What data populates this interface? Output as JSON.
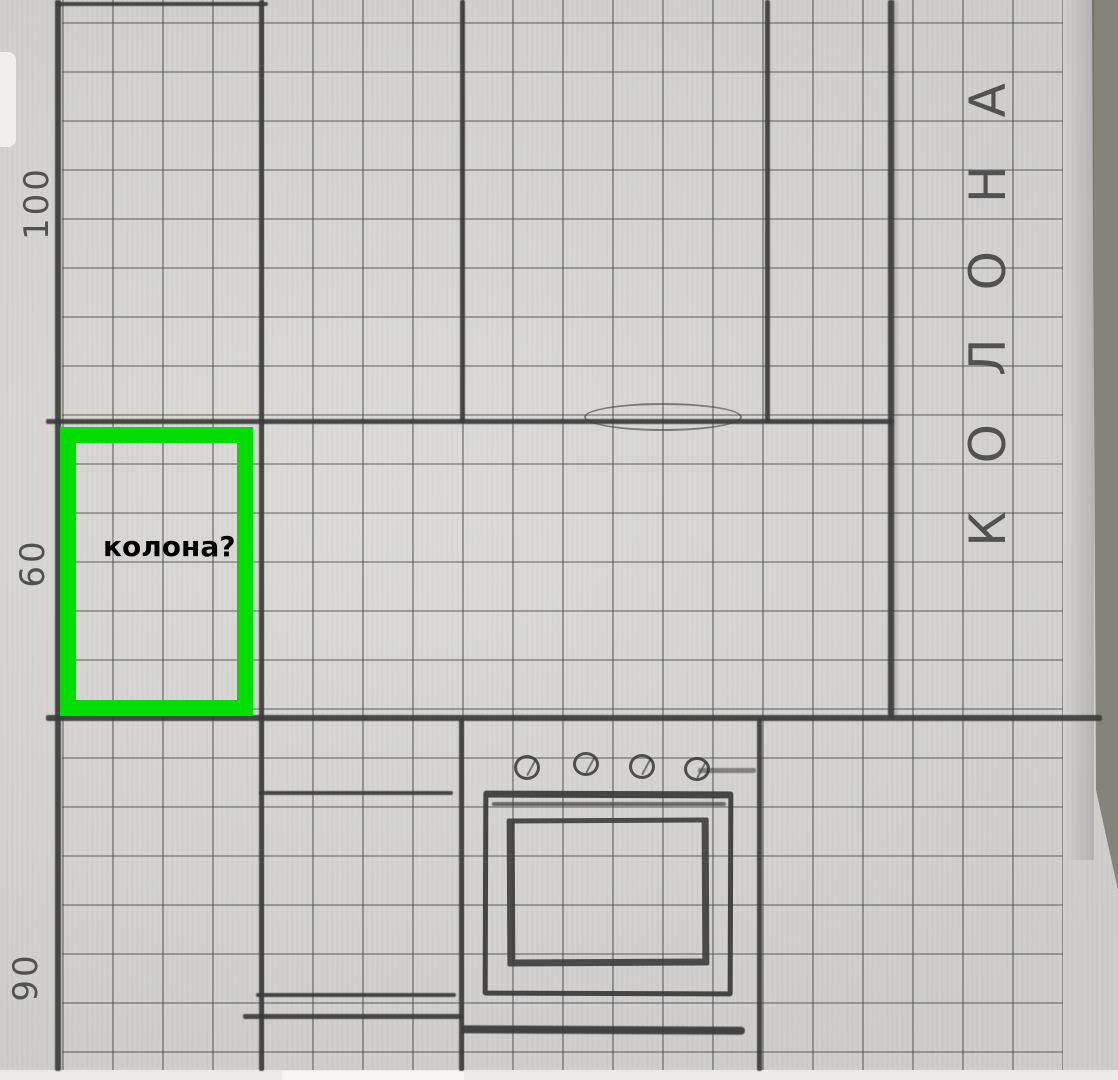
{
  "labels": {
    "wall_vertical_text": "КОЛОНА",
    "annotation_text": "колона?",
    "measurements": {
      "top": "100",
      "middle": "60",
      "bottom": "90"
    }
  },
  "colors": {
    "highlight_green": "#00dd00",
    "pencil": "#3b3b3b",
    "paper": "#d7d6d4",
    "grid_line": "#464646",
    "table_background": "#84847b",
    "annotation_text": "#000000"
  }
}
